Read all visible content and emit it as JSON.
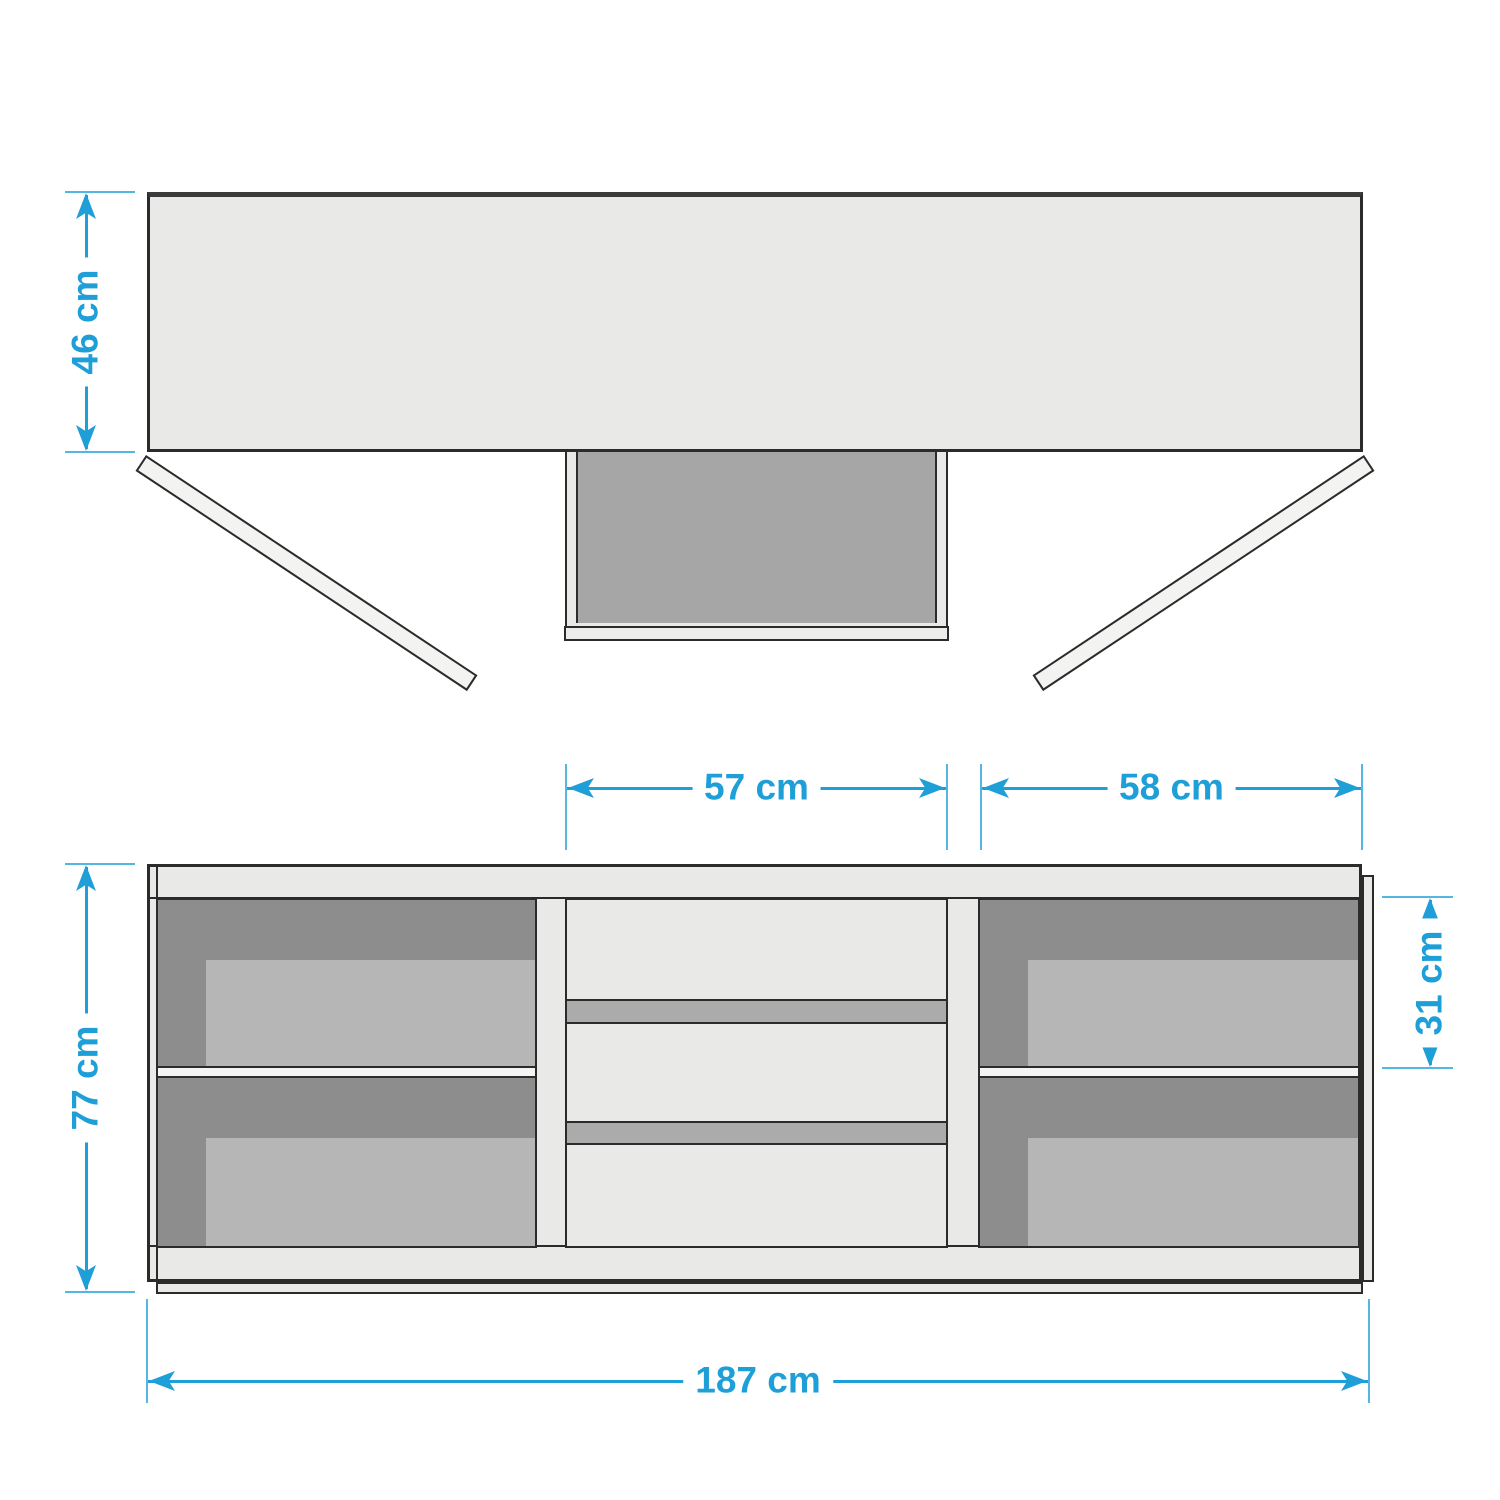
{
  "palette": {
    "blue": "#1f9fd8",
    "blue_soft": "#55b6e2",
    "bg": "#ffffff",
    "panel": "#e9e9e8",
    "door": "#f3f3f1",
    "outline": "#2b2b2b",
    "top_edge": "#3c3c3c",
    "cavity": "#a6a6a6",
    "comp_dark": "#8d8d8d",
    "comp_light": "#b6b6b6",
    "gap_strip": "#ababab",
    "shelf": "#f4f4f3"
  },
  "dimensions": {
    "depth": {
      "label": "46 cm"
    },
    "drawer_section_width": {
      "label": "57 cm"
    },
    "right_section_width": {
      "label": "58 cm"
    },
    "height": {
      "label": "77 cm"
    },
    "compartment_height": {
      "label": "31 cm"
    },
    "total_width": {
      "label": "187 cm"
    }
  }
}
